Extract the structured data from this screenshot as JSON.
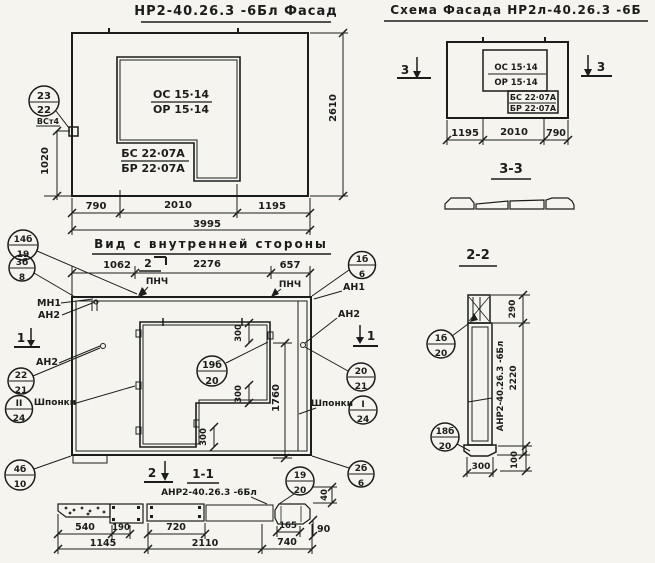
{
  "drawing": {
    "background": "#f5f4ee",
    "ink": "#1c1c1c"
  },
  "facade": {
    "title": "НР2-40.26.3 -6Бл Фасад",
    "opening_mark_top": "ОС 15·14",
    "opening_mark_bottom": "ОР 15·14",
    "block_mark_top": "БС 22·07А",
    "block_mark_bottom": "БР 22·07А",
    "balloon": {
      "top": "23",
      "bottom": "22"
    },
    "balloon_note": "ВСт4",
    "dims": {
      "w1": "790",
      "w2": "2010",
      "w3": "1195",
      "total": "3995",
      "height": "2610",
      "left_height": "1020"
    }
  },
  "schema": {
    "title": "Схема Фасада НР2л-40.26.3 -6Б",
    "opening_mark_top": "ОС 15·14",
    "opening_mark_bottom": "ОР 15·14",
    "block_mark_top": "БС 22·07А",
    "block_mark_bottom": "БР 22·07А",
    "section_mark": "3",
    "dims": {
      "w1": "1195",
      "w2": "2010",
      "w3": "790"
    }
  },
  "section_3_3": {
    "title": "3-3"
  },
  "section_2_2": {
    "title": "2-2",
    "panel_mark": "АНР2-40.26.3 -6Бл",
    "balloon_upper": {
      "top": "1б",
      "bottom": "20"
    },
    "balloon_lower": {
      "top": "18б",
      "bottom": "20"
    },
    "dims": {
      "top": "290",
      "height": "2220",
      "width": "300",
      "base": "100"
    }
  },
  "inner_view": {
    "title": "Вид с внутренней стороны",
    "section_mark_1": "1",
    "section_mark_2": "2",
    "labels": {
      "pnch": "ПНЧ",
      "mn1": "МН1",
      "an1": "АН1",
      "an2": "АН2",
      "shponki": "Шпонки"
    },
    "dims": {
      "w1": "1062",
      "w2": "2276",
      "w3": "657",
      "opening_height": "1760",
      "step": "300"
    },
    "balloons": {
      "b14": {
        "top": "14б",
        "bottom": "19"
      },
      "b3": {
        "top": "3б",
        "bottom": "8"
      },
      "b22": {
        "top": "22",
        "bottom": "21"
      },
      "bII": {
        "top": "II",
        "bottom": "24"
      },
      "b20": {
        "top": "20",
        "bottom": "21"
      },
      "bI": {
        "top": "I",
        "bottom": "24"
      },
      "b1": {
        "top": "1б",
        "bottom": "6"
      },
      "b19b": {
        "top": "19б",
        "bottom": "20"
      },
      "b2": {
        "top": "2б",
        "bottom": "6"
      },
      "b19": {
        "top": "19",
        "bottom": "20"
      },
      "b4": {
        "top": "4б",
        "bottom": "10"
      }
    }
  },
  "section_1_1": {
    "title": "1-1",
    "section_mark": "2",
    "panel_mark": "АНР2-40.26.3 -6Бл",
    "dims": {
      "a": "540",
      "b": "190",
      "c": "1145",
      "d": "720",
      "e": "2110",
      "f": "165",
      "g": "90",
      "h": "740",
      "v": "40"
    }
  }
}
